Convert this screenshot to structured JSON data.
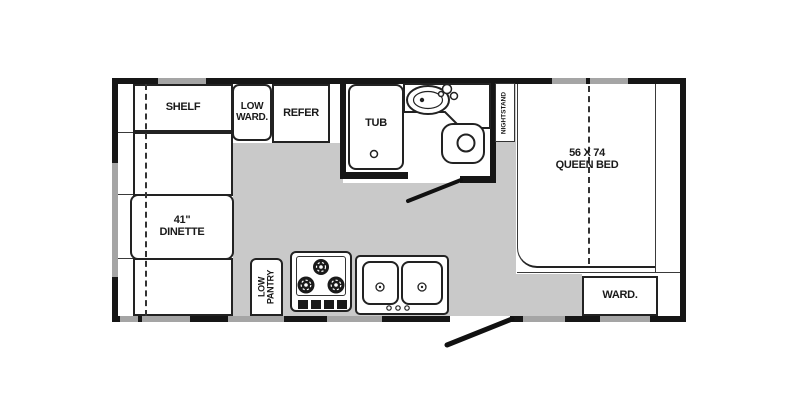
{
  "floorplan": {
    "title": "travel-trailer-floorplan",
    "areas": {
      "shelf": {
        "label": "SHELF"
      },
      "low_wardrobe": {
        "label_line1": "LOW",
        "label_line2": "WARD."
      },
      "refrigerator": {
        "label": "REFER"
      },
      "tub": {
        "label": "TUB"
      },
      "nightstand": {
        "label": "NIGHTSTAND"
      },
      "queen_bed": {
        "label_line1": "56 X 74",
        "label_line2": "QUEEN BED"
      },
      "dinette": {
        "label_line1": "41\"",
        "label_line2": "DINETTE"
      },
      "low_pantry": {
        "label_line1": "LOW",
        "label_line2": "PANTRY"
      },
      "wardrobe": {
        "label": "WARD."
      }
    },
    "icons": [
      "toilet-icon",
      "bath-sink-icon",
      "faucet-icon",
      "tub-drain-icon",
      "stove-burner-icon",
      "stove-knob-icon",
      "kitchen-sink-icon",
      "door-swing-icon",
      "entry-door-swing-icon"
    ],
    "colors": {
      "wall": "#161616",
      "floor": "#c9c9c9",
      "window": "#a5a5a5",
      "fixture_outline": "#222222",
      "background": "#ffffff"
    }
  }
}
